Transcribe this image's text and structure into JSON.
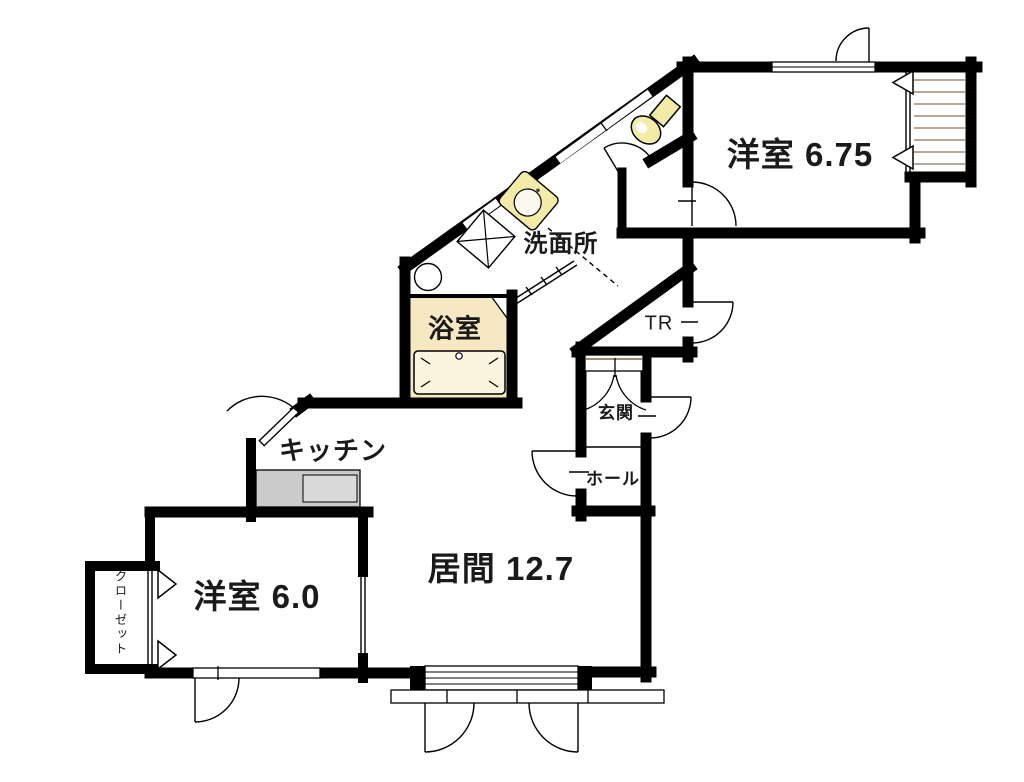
{
  "plan": {
    "type": "apartment-floor-plan",
    "rooms": {
      "western_675": {
        "label": "洋室 6.75",
        "area_tatami": 6.75
      },
      "washroom": {
        "label": "洗面所"
      },
      "bathroom": {
        "label": "浴室"
      },
      "trunk_room": {
        "label": "TR"
      },
      "entrance": {
        "label": "玄関"
      },
      "hall": {
        "label": "ホール"
      },
      "kitchen": {
        "label": "キッチン"
      },
      "living": {
        "label": "居間 12.7",
        "area_tatami": 12.7
      },
      "western_60": {
        "label": "洋室 6.0",
        "area_tatami": 6.0
      },
      "closet": {
        "label": "クローゼット"
      }
    },
    "colors": {
      "wall": "#000000",
      "bath_fill": "#f6e8c3",
      "tub_fill": "#fbf4de",
      "fixture_yellow": "#f2eca8",
      "counter_gray": "#cbcbcb",
      "counter_sink_gray": "#dadada",
      "stair_line_tan": "#a08873",
      "background": "#ffffff"
    }
  }
}
